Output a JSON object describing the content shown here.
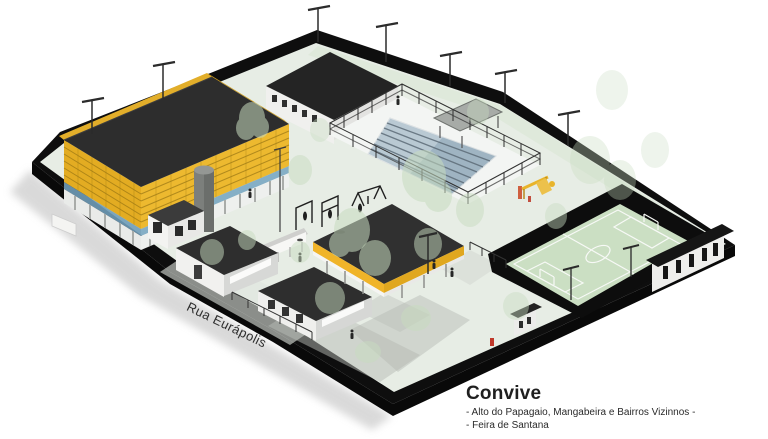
{
  "labels": {
    "street": "Rua Eurápolis",
    "title": "Convive",
    "subtitle1": "- Alto do Papagaio, Mangabeira e Bairros Vizinnos -",
    "subtitle2": "- Feira de Santana"
  },
  "scene": {
    "description": "Axonometric architectural rendering of the Convive community sports complex",
    "elements": [
      "gymnasium with yellow louvered facade and dark roof",
      "swimming pool with lane lines and perimeter fence",
      "pool-side shelter",
      "soccer field with white markings and black enclosure walls",
      "central canopy with yellow fascia",
      "service buildings with dark roofs",
      "guardhouse and water tower",
      "outdoor gym and playground",
      "black perimeter wall with street lights",
      "watercolor trees"
    ],
    "colors": {
      "background": "#ffffff",
      "facade_yellow": "#edb92f",
      "roof_dark": "#2d2d2d",
      "perimeter_black": "#0e0e0e",
      "ground_green": "#e7ede5",
      "field_green": "#cbdfc3",
      "pool_blue": "#9fb4c2",
      "clerestory_blue": "#7aa7c2",
      "tree_green": "#c8dcc0",
      "accent_red": "#c0392b"
    }
  }
}
